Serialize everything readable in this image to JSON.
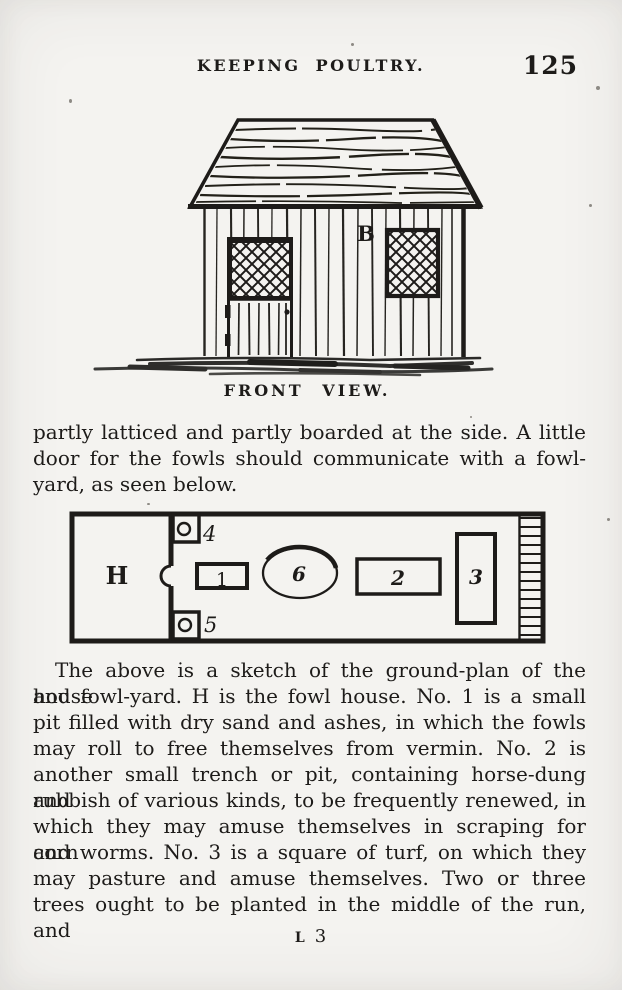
{
  "page": {
    "running_head": "KEEPING POULTRY.",
    "page_number": "125",
    "signature_letter": "L",
    "signature_number": "3"
  },
  "front_view_figure": {
    "caption": "FRONT VIEW.",
    "wall_label": "B"
  },
  "intro_paragraph": {
    "lines": [
      "partly latticed and partly boarded at the side.  A little",
      "door for the fowls should communicate with a fowl-",
      "yard, as seen below."
    ]
  },
  "ground_plan_figure": {
    "labels": {
      "h": "H",
      "n1": "1",
      "n2": "2",
      "n3": "3",
      "n4": "4",
      "n5": "5",
      "n6": "6"
    }
  },
  "body_paragraph": {
    "lines": [
      "The above is a sketch of the ground-plan of the house",
      "and fowl-yard.  H is the fowl house.  No. 1 is a small",
      "pit filled with dry sand and ashes, in which the fowls",
      "may roll to free themselves from vermin.  No. 2 is",
      "another small trench or pit, containing horse-dung and",
      "rubbish of various kinds, to be frequently renewed, in",
      "which they may amuse themselves in scraping for corn",
      "and worms.  No. 3 is a square of turf, on which they",
      "may pasture and amuse themselves.  Two or three",
      "trees ought to be planted in the middle of the run, and"
    ]
  }
}
